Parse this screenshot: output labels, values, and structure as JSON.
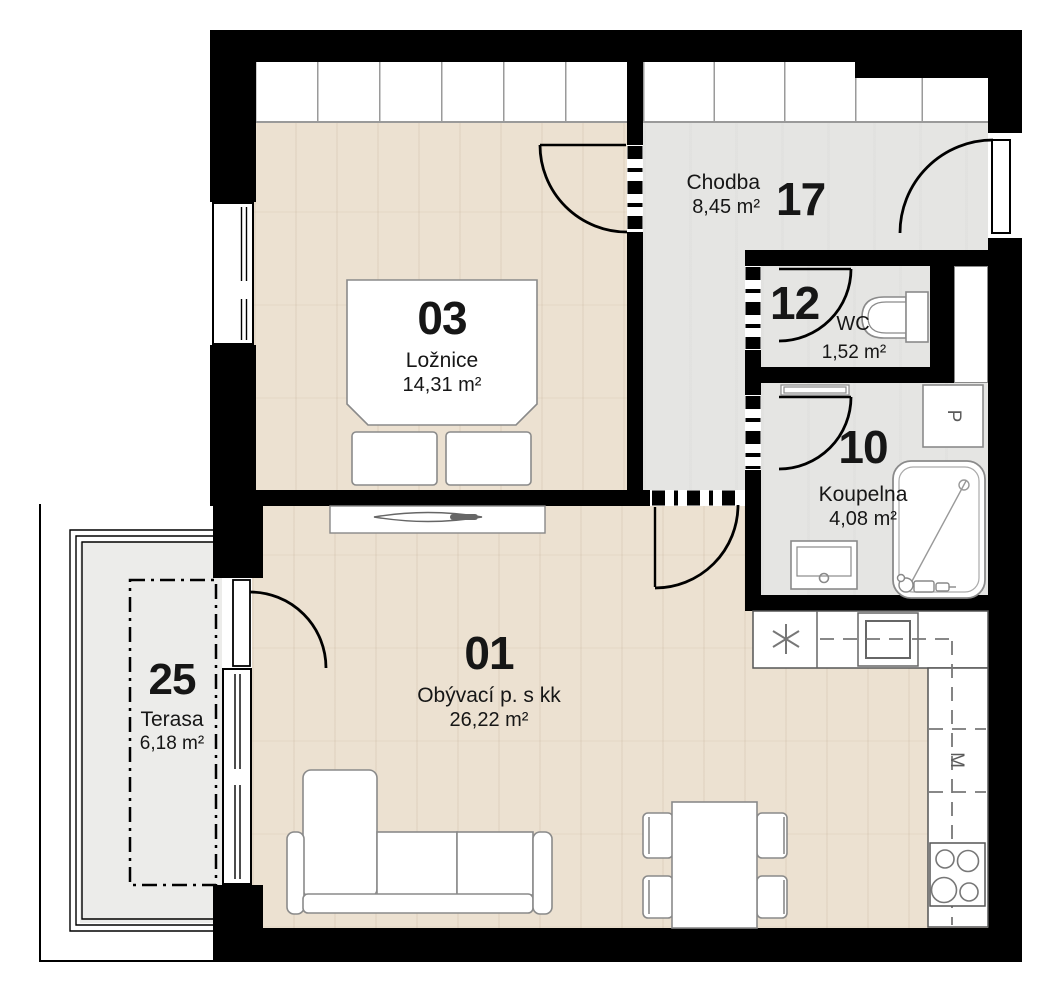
{
  "rooms": [
    {
      "number": "03",
      "name": "Ložnice",
      "area": "14,31 m²"
    },
    {
      "number": "17",
      "name": "Chodba",
      "area": "8,45 m²"
    },
    {
      "number": "12",
      "name": "WC",
      "area": "1,52 m²"
    },
    {
      "number": "10",
      "name": "Koupelna",
      "area": "4,08 m²"
    },
    {
      "number": "01",
      "name": "Obývací p. s kk",
      "area": "26,22 m²"
    },
    {
      "number": "25",
      "name": "Terasa",
      "area": "6,18 m²"
    }
  ],
  "appliances": {
    "washing_machine": "P",
    "dishwasher": "M"
  },
  "colors": {
    "wall": "#000000",
    "wood_floor": "#ece1d1",
    "tile_floor": "#e5e5e3",
    "terrace_floor": "#ececea",
    "label_color": "#161616"
  }
}
